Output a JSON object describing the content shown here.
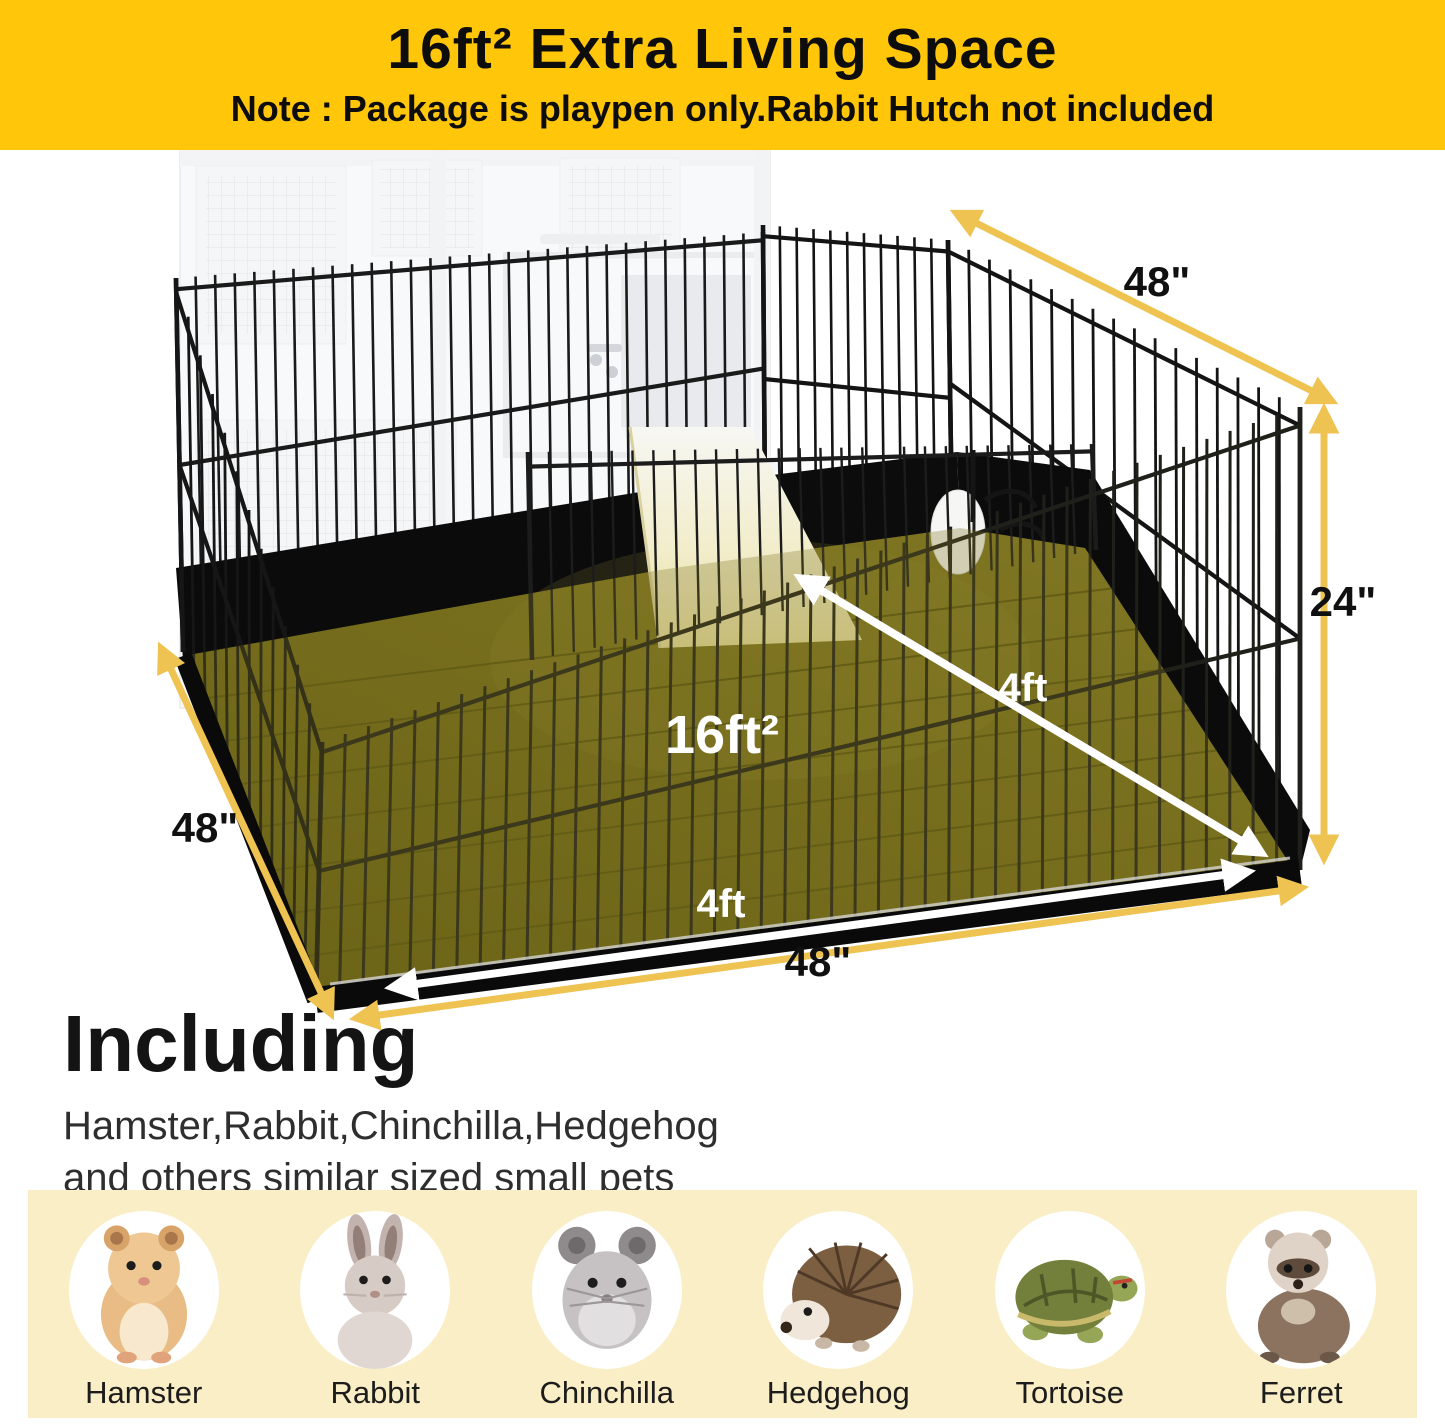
{
  "banner": {
    "title": "16ft² Extra Living Space",
    "note": "Note : Package is playpen only.Rabbit Hutch not included",
    "background": "#ffc60a"
  },
  "scene": {
    "top_width_label": "48\"",
    "height_label": "24\"",
    "left_depth_label": "48\"",
    "bottom_width_label": "48\"",
    "floor_area_label": "16ft²",
    "floor_side_label": "4ft",
    "floor_front_label": "4ft"
  },
  "including": {
    "heading": "Including",
    "line1": "Hamster,Rabbit,Chinchilla,Hedgehog",
    "line2": "and others similar sized small pets"
  },
  "pets": {
    "items": [
      {
        "label": "Hamster"
      },
      {
        "label": "Rabbit"
      },
      {
        "label": "Chinchilla"
      },
      {
        "label": "Hedgehog"
      },
      {
        "label": "Tortoise"
      },
      {
        "label": "Ferret"
      }
    ]
  },
  "colors": {
    "banner_yellow": "#ffc60a",
    "arrow_gold": "#efc352",
    "floor_highlight": "#6f6817",
    "pets_panel_cream": "#faeec6"
  }
}
